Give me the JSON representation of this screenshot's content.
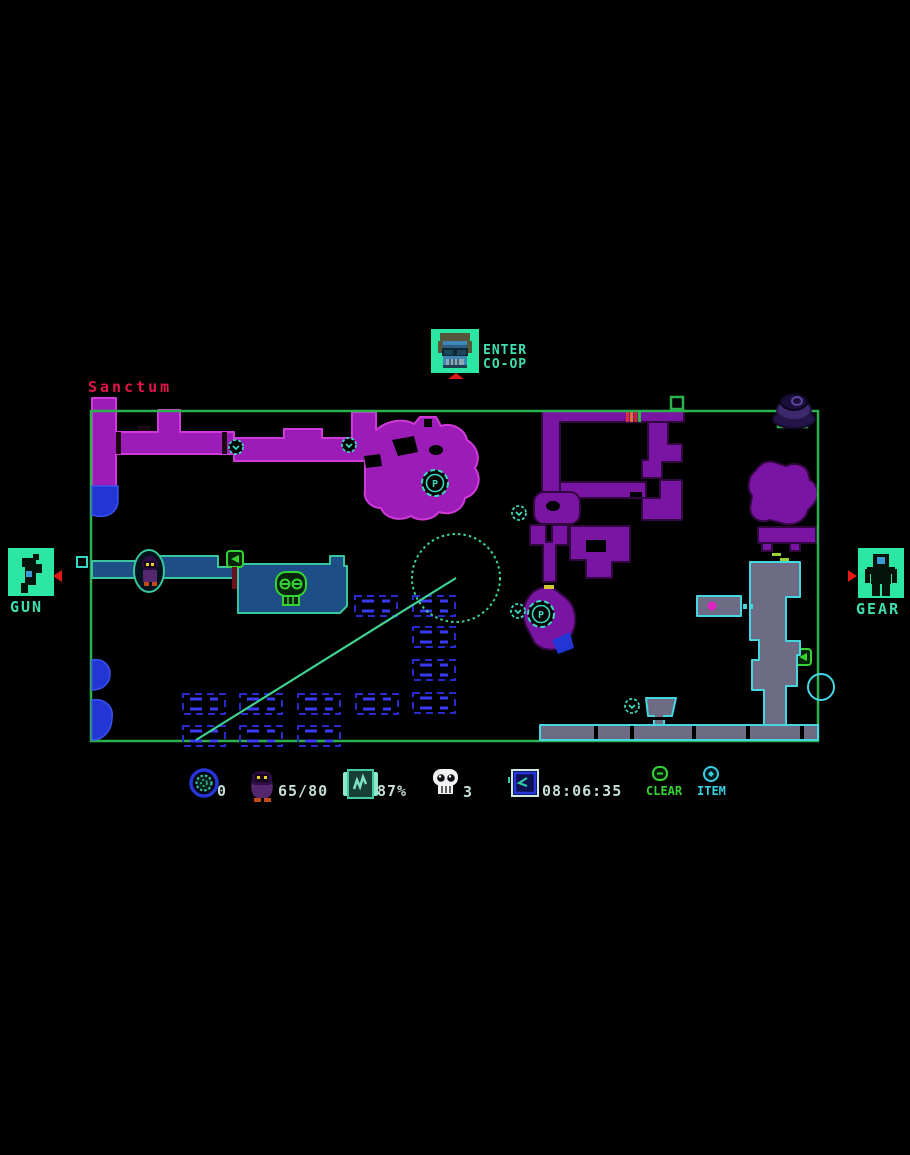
{
  "location": {
    "name": "Sanctum"
  },
  "coop": {
    "line1": "ENTER",
    "line2": "CO-OP"
  },
  "weapon_panel": {
    "label": "GUN"
  },
  "gear_panel": {
    "label": "GEAR"
  },
  "hud": {
    "orb_count": "0",
    "loot_count": "65/80",
    "map_percent": "87%",
    "skull_count": "3",
    "time": "08:06:35",
    "clear_label": "CLEAR",
    "item_label": "ITEM"
  },
  "map": {
    "p_marker_label": "P"
  },
  "icons": {
    "coop_portrait": "pixel-face",
    "weapon_slot": "pistol",
    "gear_slot": "robot-suit",
    "orb": "blue-ring-gear",
    "loot": "purple-bird",
    "map_scroll": "teal-scroll",
    "skull": "white-skull",
    "clock": "blue-clock",
    "clear": "green-minus-circle",
    "item": "cyan-diamond-circle"
  },
  "colors": {
    "panel_teal": "#2ce6a4",
    "text_teal": "#3fe0b0",
    "title_red": "#e0164a",
    "border_green": "#2db04e",
    "purple_bright": "#9c1cb8",
    "purple_dark": "#7a14a2",
    "platform_blue": "#1d4f86",
    "slate_gray": "#6e6b84",
    "marker_teal": "#3ad8c0",
    "hud_text": "#c6dfd3"
  }
}
